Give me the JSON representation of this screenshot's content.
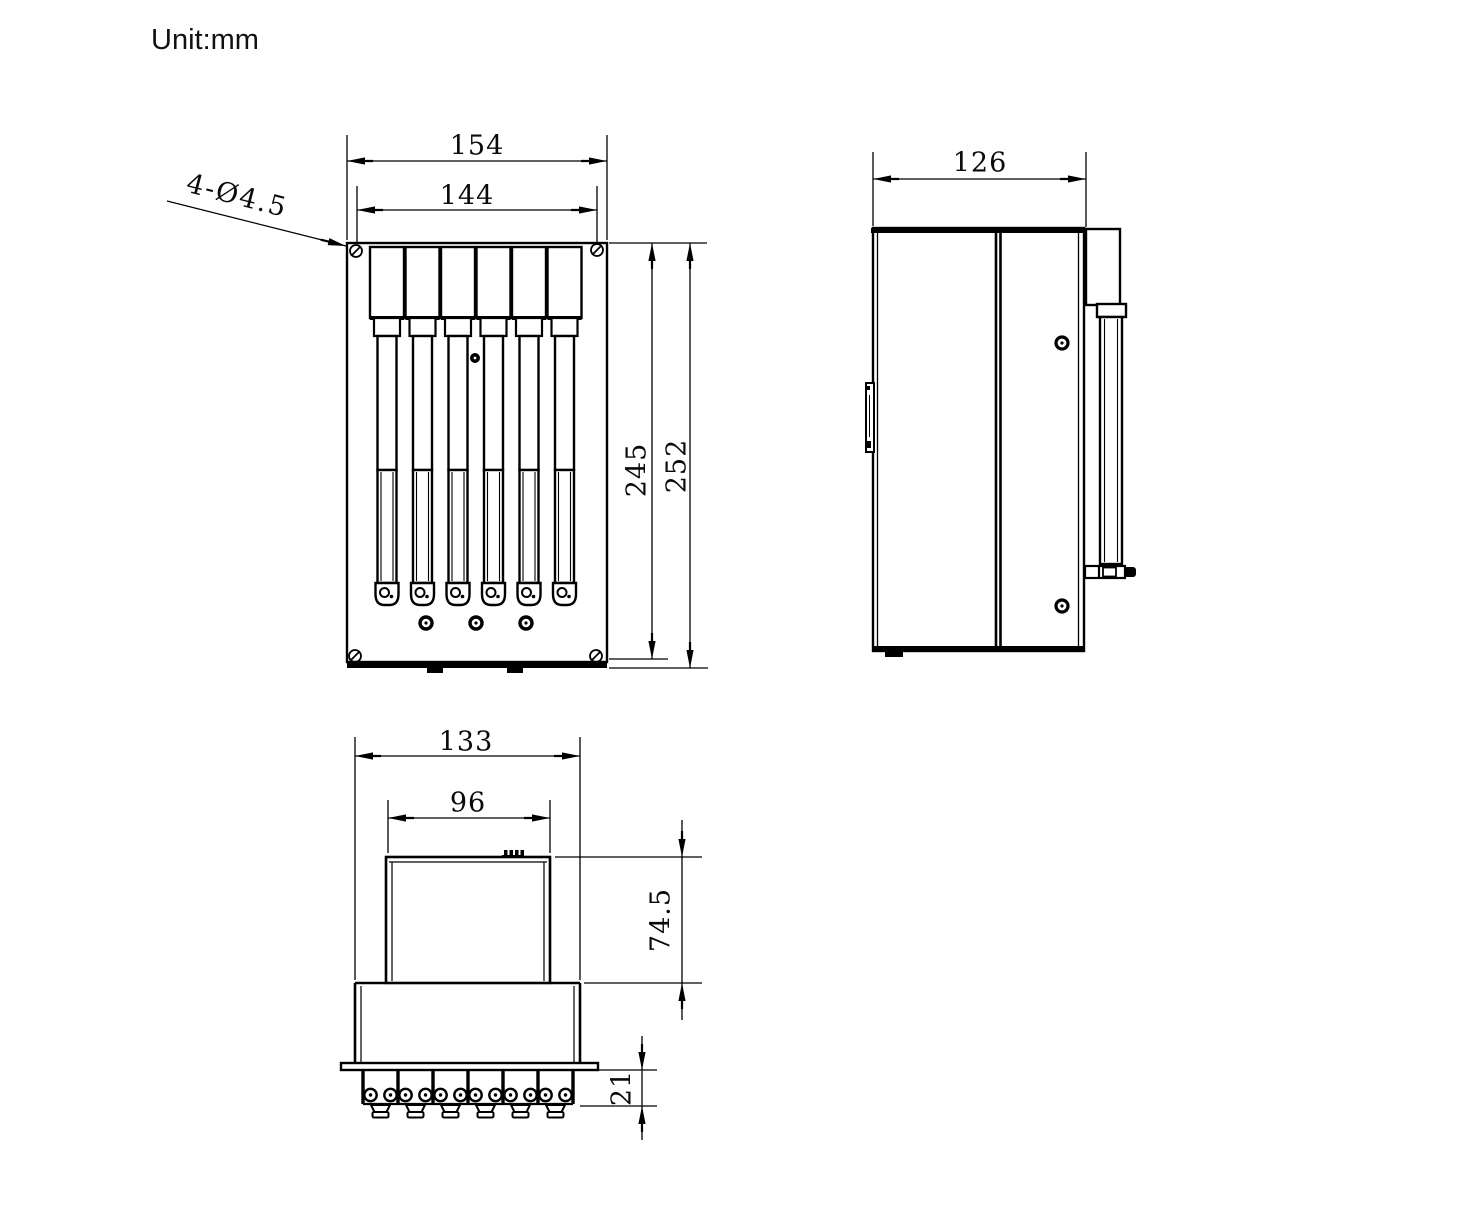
{
  "unit_label": "Unit:mm",
  "dimensions": {
    "front": {
      "width_outer": "154",
      "width_inner": "144",
      "height_inner": "245",
      "height_outer": "252",
      "mount_holes_note": "4-Ø4.5"
    },
    "side": {
      "depth": "126"
    },
    "bottom": {
      "width_outer": "133",
      "width_inner": "96",
      "height_body": "74.5",
      "height_terminals": "21"
    }
  }
}
